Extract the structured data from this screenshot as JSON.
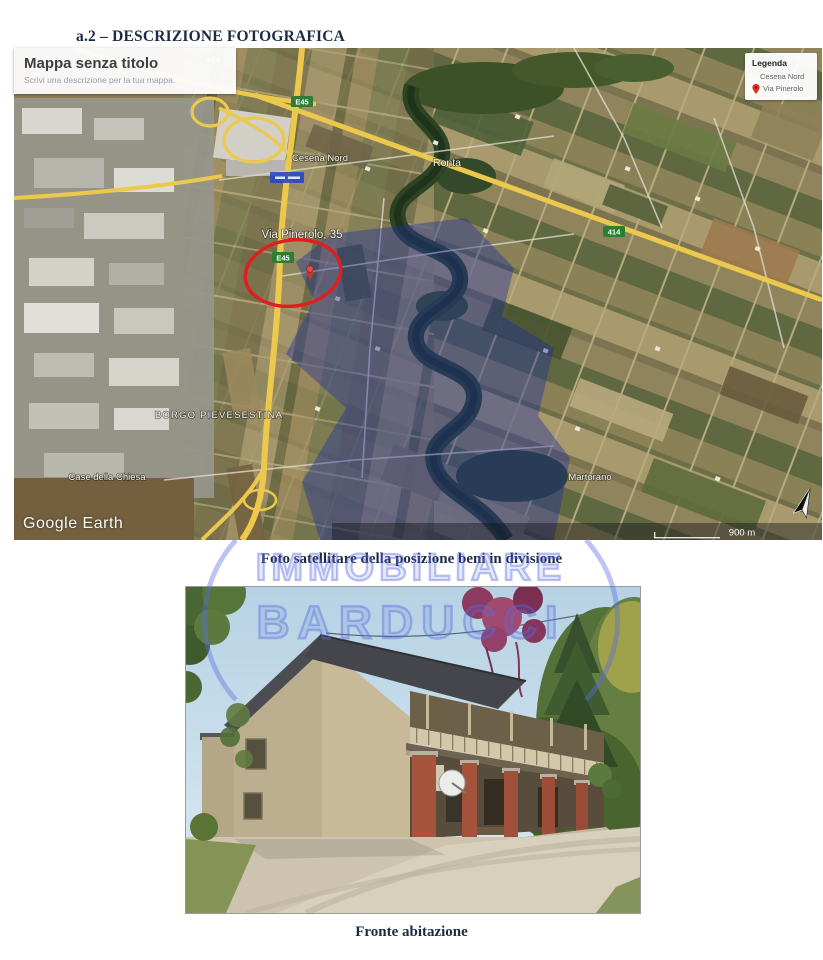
{
  "page": {
    "heading": "a.2 – DESCRIZIONE FOTOGRAFICA"
  },
  "map": {
    "title_box": {
      "title": "Mappa senza titolo",
      "subtitle": "Scrivi una descrizione per la tua mappa."
    },
    "legend": {
      "title": "Legenda",
      "item_region": "Cesena Nord",
      "item_pin": "Via Pinerolo"
    },
    "labels": {
      "cesena_nord": "Cesena Nord",
      "ronta": "Ronta",
      "via_pinerolo": "Via Pinerolo, 35",
      "borgo_pievesestina": "BORGO PIEVESESTINA",
      "case_della_chiesa": "Case della Chiesa",
      "martorano": "Martorano"
    },
    "shields": {
      "a14": "A14",
      "e45_top": "E45",
      "e45_site": "E45",
      "sp414": "414"
    },
    "credit": "Google Earth",
    "scale_label": "900 m"
  },
  "captions": {
    "satellite": "Foto satellitare della posizione beni in divisione",
    "house": "Fronte abitazione"
  },
  "watermark": {
    "word1": "IMMOBILIARE",
    "word2": "BARDUCCI"
  },
  "colors": {
    "annotation_red": "#dd1f1f",
    "watermark_blue": "#5a6ce1",
    "heading_text": "#1c2b45",
    "road_yellow": "#ecc94d"
  }
}
